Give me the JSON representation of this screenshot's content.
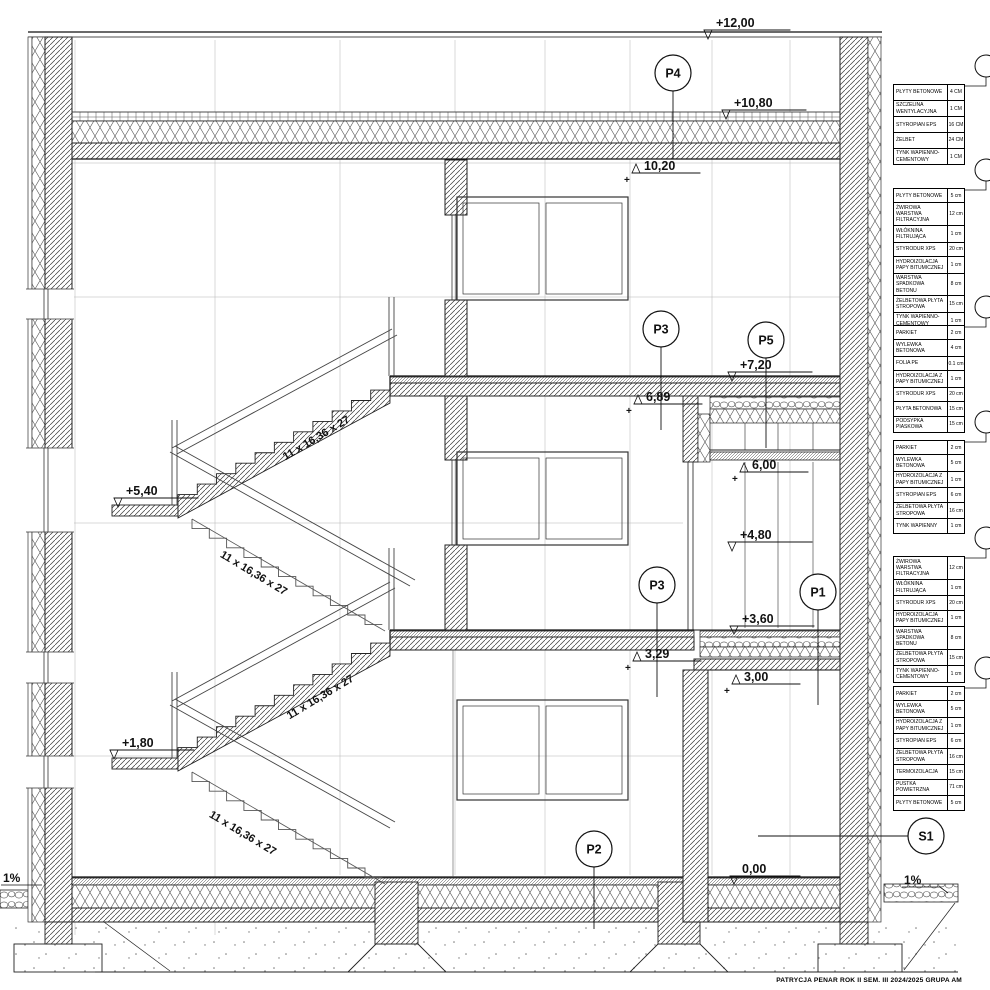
{
  "colors": {
    "ink": "#1a1a1a",
    "paper": "#ffffff"
  },
  "title_block": {
    "text": "PATRYCJA PENAR ROK II SEM. III 2024/2025 GRUPA AM"
  },
  "levels": [
    {
      "label": "+12,00"
    },
    {
      "label": "+10,80"
    },
    {
      "label": "10,20",
      "plus": "+"
    },
    {
      "label": "+7,20"
    },
    {
      "label": "6,89",
      "plus": "+"
    },
    {
      "label": "6,00",
      "plus": "+"
    },
    {
      "label": "+5,40"
    },
    {
      "label": "+4,80"
    },
    {
      "label": "+3,60"
    },
    {
      "label": "3,29",
      "plus": "+"
    },
    {
      "label": "3,00",
      "plus": "+"
    },
    {
      "label": "+1,80"
    },
    {
      "label": "0,00"
    }
  ],
  "section_markers": [
    {
      "label": "P4"
    },
    {
      "label": "P3"
    },
    {
      "label": "P5"
    },
    {
      "label": "P3"
    },
    {
      "label": "P1"
    },
    {
      "label": "P2"
    },
    {
      "label": "S1"
    }
  ],
  "stair_labels": [
    {
      "label": "11 x 16,36 x 27"
    },
    {
      "label": "11 x 16,36 x 27"
    },
    {
      "label": "11 x 16,36 x 27"
    },
    {
      "label": "11 x 16,36 x 27"
    }
  ],
  "slope_labels": [
    {
      "label": "1%"
    },
    {
      "label": "1%"
    }
  ],
  "tables": [
    {
      "rows": [
        {
          "m": "PŁYTY BETONOWE",
          "t": "4 CM"
        },
        {
          "m": "SZCZELINA WENTYLACYJNA",
          "t": "1 CM"
        },
        {
          "m": "STYROPIAN EPS",
          "t": "16 CM"
        },
        {
          "m": "ŻELBET",
          "t": "24 CM"
        },
        {
          "m": "TYNK WAPIENNO-CEMENTOWY",
          "t": "1 CM"
        }
      ]
    },
    {
      "rows": [
        {
          "m": "PŁYTY BETONOWE",
          "t": "5 cm"
        },
        {
          "m": "ŻWIROWA WARSTWA FILTRACYJNA",
          "t": "12 cm"
        },
        {
          "m": "WŁÓKNINA FILTRUJĄCA",
          "t": "1 cm"
        },
        {
          "m": "STYRODUR XPS",
          "t": "20 cm"
        },
        {
          "m": "HYDROIZOLACJA PAPY BITUMICZNEJ",
          "t": "1 cm"
        },
        {
          "m": "WARSTWA SPADKOWA BETONU",
          "t": "8 cm"
        },
        {
          "m": "ŻELBETOWA PŁYTA STROPOWA",
          "t": "15 cm"
        },
        {
          "m": "TYNK WAPIENNO-CEMENTOWY",
          "t": "1 cm"
        }
      ]
    },
    {
      "rows": [
        {
          "m": "PARKIET",
          "t": "2 cm"
        },
        {
          "m": "WYLEWKA BETONOWA",
          "t": "4 cm"
        },
        {
          "m": "FOLIA PE",
          "t": "0.1 cm"
        },
        {
          "m": "HYDROIZOLACJA Z PAPY BITUMICZNEJ",
          "t": "1 cm"
        },
        {
          "m": "STYRODUR XPS",
          "t": "20 cm"
        },
        {
          "m": "PŁYTA BETONOWA",
          "t": "15 cm"
        },
        {
          "m": "PODSYPKA PIASKOWA",
          "t": "15 cm"
        }
      ]
    },
    {
      "rows": [
        {
          "m": "PARKIET",
          "t": "2 cm"
        },
        {
          "m": "WYLEWKA BETONOWA",
          "t": "5 cm"
        },
        {
          "m": "HYDROIZOLACJA Z PAPY BITUMICZNEJ",
          "t": "1 cm"
        },
        {
          "m": "STYROPIAN EPS",
          "t": "6 cm"
        },
        {
          "m": "ŻELBETOWA PŁYTA STROPOWA",
          "t": "16 cm"
        },
        {
          "m": "TYNK WAPIENNY",
          "t": "1 cm"
        }
      ]
    },
    {
      "rows": [
        {
          "m": "ŻWIROWA WARSTWA FILTRACYJNA",
          "t": "12 cm"
        },
        {
          "m": "WŁÓKNINA FILTRUJĄCA",
          "t": "1 cm"
        },
        {
          "m": "STYRODUR XPS",
          "t": "20 cm"
        },
        {
          "m": "HYDROIZOLACJA PAPY BITUMICZNEJ",
          "t": "1 cm"
        },
        {
          "m": "WARSTWA SPADKOWA BETONU",
          "t": "8 cm"
        },
        {
          "m": "ŻELBETOWA PŁYTA STROPOWA",
          "t": "15 cm"
        },
        {
          "m": "TYNK WAPIENNO-CEMENTOWY",
          "t": "1 cm"
        }
      ]
    },
    {
      "rows": [
        {
          "m": "PARKIET",
          "t": "2 cm"
        },
        {
          "m": "WYLEWKA BETONOWA",
          "t": "5 cm"
        },
        {
          "m": "HYDROIZOLACJA Z PAPY BITUMICZNEJ",
          "t": "1 cm"
        },
        {
          "m": "STYROPIAN EPS",
          "t": "6 cm"
        },
        {
          "m": "ŻELBETOWA PŁYTA STROPOWA",
          "t": "16 cm"
        },
        {
          "m": "TERMOIZOLACJA",
          "t": "15 cm"
        },
        {
          "m": "PUSTKA POWIETRZNA",
          "t": "71 cm"
        },
        {
          "m": "PŁYTY BETONOWE",
          "t": "5 cm"
        }
      ]
    }
  ]
}
